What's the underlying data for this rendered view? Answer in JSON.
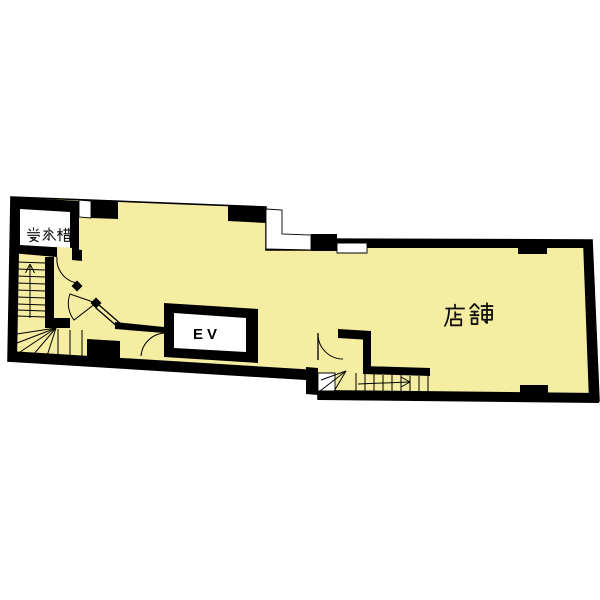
{
  "plan": {
    "rooms": [
      {
        "id": "water-tank",
        "label": "受水槽"
      },
      {
        "id": "elevator",
        "label": "EV"
      },
      {
        "id": "shop",
        "label": "店舗"
      }
    ],
    "features": {
      "staircases": [
        "left-winder-staircase-up",
        "bottom-winder-staircase"
      ],
      "doors": [
        "corridor-door-top",
        "corridor-door-mid",
        "elevator-lobby-door",
        "bottom-stair-door"
      ],
      "windows": [
        "top-left-window",
        "top-step-window",
        "shop-top-window",
        "bottom-landing-window"
      ]
    },
    "colors": {
      "floor": "#F5EDA2",
      "wall": "#000000",
      "background": "#FFFFFF"
    }
  }
}
